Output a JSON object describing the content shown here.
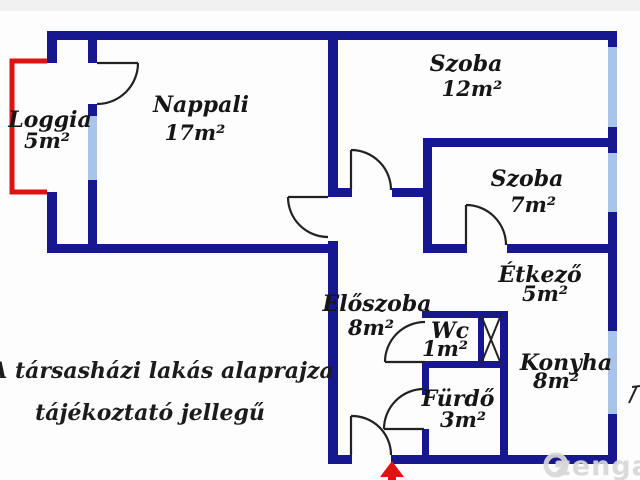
{
  "plan": {
    "rooms": {
      "loggia": {
        "name": "Loggia",
        "area": "5m²"
      },
      "nappali": {
        "name": "Nappali",
        "area": "17m²"
      },
      "szoba_12": {
        "name": "Szoba",
        "area": "12m²"
      },
      "szoba_7": {
        "name": "Szoba",
        "area": "7m²"
      },
      "etkezo": {
        "name": "Étkező",
        "area": "5m²"
      },
      "eloszoba": {
        "name": "Előszoba",
        "area": "8m²"
      },
      "wc": {
        "name": "Wc",
        "area": "1m²"
      },
      "konyha": {
        "name": "Konyha",
        "area": "8m²"
      },
      "furdo": {
        "name": "Fürdő",
        "area": "3m²"
      }
    },
    "disclaimer": {
      "line1": "A társasházi lakás alaprajza",
      "line2": "tájékoztató jellegű"
    },
    "watermark": {
      "text": "zenga"
    },
    "colors": {
      "wall": "#17178f",
      "window": "#a9c4ea",
      "loggia_outline": "#e01212",
      "entrance_arrow": "#e01212",
      "label_text": "#161616",
      "watermark": "#d8d8d8"
    }
  }
}
